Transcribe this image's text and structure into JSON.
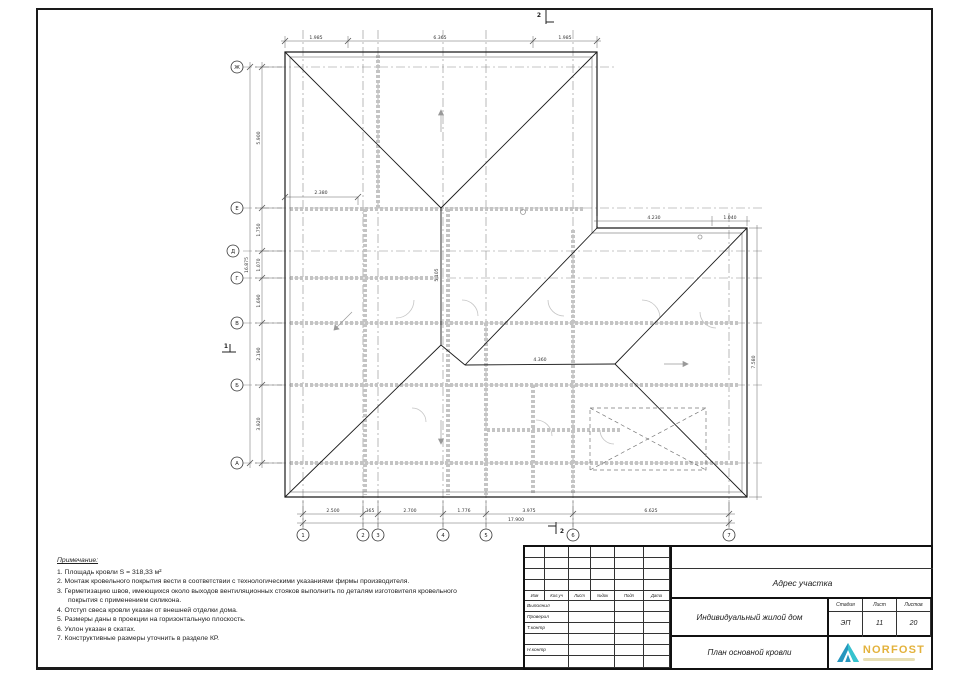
{
  "drawing": {
    "row_axes": [
      "Ж",
      "Е",
      "Д",
      "Г",
      "В",
      "Б",
      "А"
    ],
    "col_axes": [
      "1",
      "2",
      "3",
      "4",
      "5",
      "6",
      "7"
    ],
    "dims_bottom": [
      "2.500",
      "365",
      "2.700",
      "1.776",
      "3.975",
      "6.625"
    ],
    "dim_bottom_total": "17.900",
    "dims_left": [
      "5.900",
      "1.750",
      "1.070",
      "1.690",
      "2.190",
      "3.920"
    ],
    "dim_left_total": "16.875",
    "dims_top": [
      "1.985",
      "6.365",
      "1.985"
    ],
    "dims_wing": [
      "4.230",
      "1.040"
    ],
    "dim_right": "7.580",
    "dim_inner": "2.380",
    "dim_ridge_v": "5.105",
    "dim_ridge_h": "4.360",
    "mark_vertical": "2",
    "mark_horizontal": "1"
  },
  "notes": {
    "title": "Примечание:",
    "items": [
      "1. Площадь кровли S = 318,33 м²",
      "2. Монтаж кровельного покрытия вести в соответствии с технологическими указаниями  фирмы производителя.",
      "3. Герметизацию швов, имеющихся около выходов вентиляционных стояков выполнить по деталям изготовителя кровельного покрытия с применением силикона.",
      "4. Отступ свеса кровли указан от внешней отделки дома.",
      "5. Размеры даны в проекции на горизонтальную плоскость.",
      "6. Уклон указан в скатах.",
      "7. Конструктивные размеры уточнить в разделе КР."
    ]
  },
  "titleblock": {
    "rev_headers": [
      "Изм",
      "Кол.уч",
      "Лист",
      "№док",
      "Подп",
      "Дата"
    ],
    "sign_rows": [
      "Выполнил",
      "Проверил",
      "Т.контр",
      "",
      "Н.контр",
      ""
    ],
    "address_label": "Адрес участка",
    "object_name": "Индивидуальный жилой дом",
    "drawing_name": "План основной кровли",
    "stage_header": "Стадия",
    "sheet_header": "Лист",
    "sheets_header": "Листов",
    "stage": "ЭП",
    "sheet_no": "11",
    "sheets_total": "20",
    "logo_text": "NORFOST"
  },
  "colors": {
    "line": "#1b1b1b",
    "dim": "#444444",
    "axis": "#8a8a8a",
    "underlay": "#c4c4c4",
    "logo_gold": "#E3B23C",
    "logo_blue": "#2596BE",
    "logo_teal": "#36C3CE"
  }
}
